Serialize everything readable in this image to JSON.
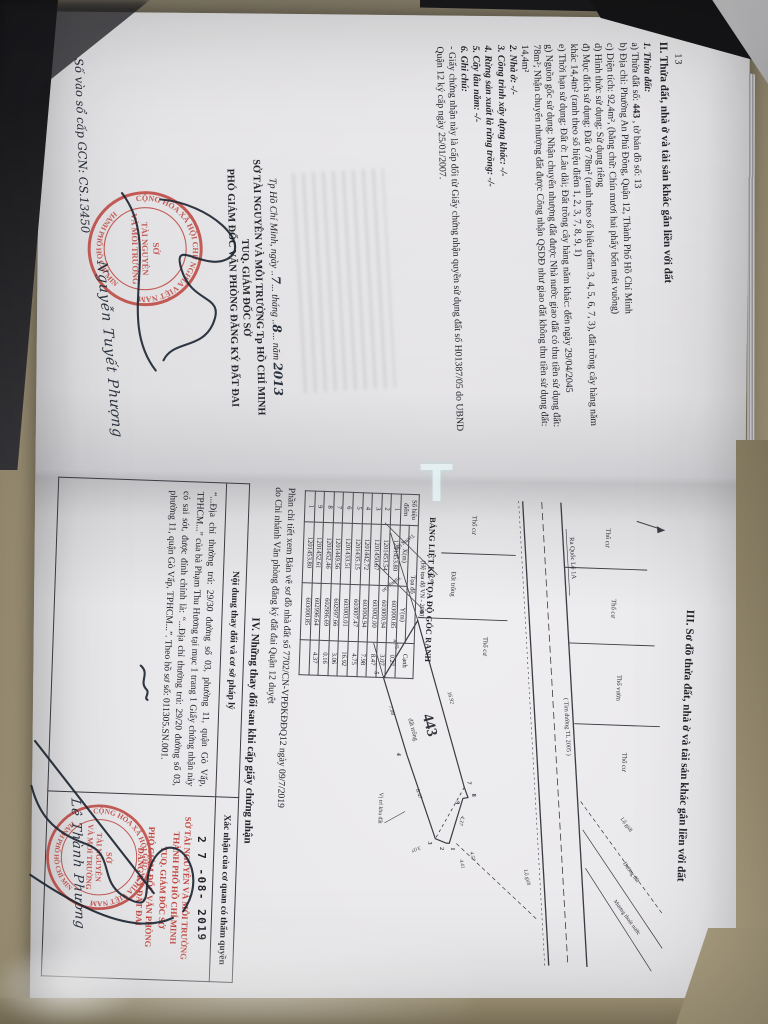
{
  "photo": {
    "watermark_glyph": "T"
  },
  "seal": {
    "ring_top": "CỘNG HÒA XÃ HỘI CHỦ NGHĨA VIỆT NAM",
    "ring_bottom": "★ THÀNH PHỐ HỒ CHÍ MINH ★",
    "center_line1": "SỞ",
    "center_line2": "TÀI NGUYÊN",
    "center_line3": "VÀ MÔI TRƯỜNG"
  },
  "left_page": {
    "page_number": "13",
    "section2": {
      "heading": "II. Thửa đất, nhà ở và tài sản khác gắn liền với đất",
      "item1_label": "1. Thửa đất:",
      "line_a_pre": "a) Thửa đất số:",
      "line_a_value": "443",
      "line_a_post": " , tờ bản đồ số: 13",
      "line_b": "b) Địa chỉ: Phường An Phú Đông, Quận 12, Thành Phố Hồ Chí Minh",
      "line_c": "c) Diện tích: 92,4m², (bằng chữ: Chín mươi hai phẩy bốn mét vuông)",
      "line_d": "d) Hình thức sử dụng: Sử dụng riêng",
      "line_dd": "đ) Mục đích sử dụng: Đất ở 78m² (ranh theo số hiệu điểm 3, 4, 5, 6, 7, 3), đất trồng cây hàng năm khác 14,4m² (ranh theo số hiệu điểm 1, 2, 3, 7, 8, 9, 1)",
      "line_e": "e) Thời hạn sử dụng: Đất ở: Lâu dài; Đất trồng cây hàng năm khác: đến ngày 29/04/2045",
      "line_g": "g) Nguồn gốc sử dụng: Nhận chuyển nhượng đất được Nhà nước giao đất có thu tiền sử dụng đất: 78m²; Nhận chuyển nhượng đất được Công nhận QSDĐ như giao đất không thu tiền sử dụng đất: 14,4m²",
      "item2": "2. Nhà ở: -/-",
      "item3": "3. Công trình xây dựng khác: -/-",
      "item4": "4. Rừng sản xuất là rừng trồng: -/-",
      "item5": "5. Cây lâu năm: -/-",
      "item6_label": "6. Ghi chú:",
      "note": "- Giấy chứng nhận này là cấp đổi từ Giấy chứng nhận quyền sử dụng đất số H01387/05 do UBND Quận 12 ký cấp ngày 25/01/2007."
    },
    "signing": {
      "place_prefix": "Tp Hồ Chí Minh, ngày",
      "day": "7",
      "mid1": "tháng",
      "month": "8",
      "mid2": "năm",
      "year": "2013",
      "office": "SỞ TÀI NGUYÊN VÀ MÔI TRƯỜNG Tp HỒ CHÍ MINH",
      "tuq": "TUQ. GIÁM ĐỐC SỞ",
      "title": "PHÓ GIÁM ĐỐC VĂN PHÒNG ĐĂNG KÝ ĐẤT ĐAI",
      "signer": "Nguyễn Tuyết Phượng",
      "book_entry_label": "Số vào sổ cấp GCN:",
      "book_entry_value": "CS.13450"
    }
  },
  "right_page": {
    "section3_heading": "III. Sơ đồ thửa đất, nhà ở và tài sản khác gắn liền với đất",
    "diagram": {
      "parcel_number": "443",
      "parcel_type": "đất trống",
      "road_label": "Ra Quốc Lộ 1A",
      "centerline_label": "( Tim đường TL 2005 )",
      "labels": [
        "Thổ cư",
        "Thổ cư",
        "Thổ vườn",
        "Thổ cư",
        "Thổ cư",
        "Đất trống",
        "Thổ cư",
        "Lộ giới",
        "Đường đất",
        "Mương thoát nước",
        "Tường rào",
        "Tường rào",
        "Vị trí khu đất",
        "Lộ giới"
      ],
      "vertices": [
        "1",
        "2",
        "3",
        "4",
        "5",
        "6",
        "7",
        "8",
        "9"
      ],
      "dims": [
        "16.92",
        "8.47",
        "7.98",
        "4.75",
        "4.37",
        "24.91",
        "4.57",
        "4.41",
        "3.07"
      ]
    },
    "coord_table": {
      "title": "BẢNG LIỆT KÊ TỌA ĐỘ GÓC RANH",
      "subtitle": "(Hệ tọa độ VN - 2000)",
      "col_point": "Số hiệu điểm",
      "col_coord": "Tọa độ",
      "col_x": "X(m)",
      "col_y": "Y(m)",
      "col_edge": "Cạnh",
      "rows": [
        [
          "1",
          "1201453.80",
          "603000.85",
          "0.27"
        ],
        [
          "2",
          "1201453.54",
          "603000.94",
          "3.07"
        ],
        [
          "3",
          "1201450.67",
          "603002.00",
          "8.47"
        ],
        [
          "4",
          "1201442.72",
          "603004.94",
          "7.98"
        ],
        [
          "5",
          "1201435.15",
          "603007.47",
          "4.75"
        ],
        [
          "6",
          "1201433.51",
          "603003.01",
          "16.92"
        ],
        [
          "7",
          "1201449.56",
          "602997.66",
          "3.06"
        ],
        [
          "8",
          "1201452.46",
          "602996.69",
          "0.16"
        ],
        [
          "9",
          "1201452.61",
          "602996.64",
          "4.37"
        ],
        [
          "1",
          "1201453.80",
          "603000.85",
          ""
        ]
      ]
    },
    "detail_note_line1": "Phần chi tiết xem Bản vẽ sơ đồ nhà đất số 7702/CN-VPĐKĐĐQ12 ngày 09/7/2019",
    "detail_note_line2": "do Chi nhánh Văn phòng đăng ký đất đai Quận 12 duyệt",
    "section4_heading": "IV. Những thay đổi sau khi cấp giấy chứng nhận",
    "change_table": {
      "col1": "Nội dung thay đổi và cơ sở pháp lý",
      "col2": "Xác nhận của cơ quan có thẩm quyền",
      "entry_text": "“...Địa chỉ thường trú: 29/30 đường số 03, phường 11, quận Gò Vấp, TPHCM...” của bà Phạm Thu Hương tại mục 1 trang 1 Giấy chứng nhận này có sai sót, được đính chính là: “...Địa chỉ thường trú: 29/20 đường số 03, phường 11, quận Gò Vấp, TPHCM...”. Theo hồ sơ số: 011305.SN.001.",
      "date_stamp": "2 7 -08- 2019",
      "red_line1": "SỞ TÀI NGUYÊN VÀ MÔI TRƯỜNG",
      "red_line2": "THÀNH PHỐ HỒ CHÍ MINH",
      "red_line3": "TUQ. GIÁM ĐỐC SỞ",
      "red_line4": "PHÓ GIÁM ĐỐC VĂN PHÒNG",
      "red_line5": "ĐĂNG KÝ ĐẤT ĐAI",
      "signer": "Lê Thành Phương"
    }
  }
}
